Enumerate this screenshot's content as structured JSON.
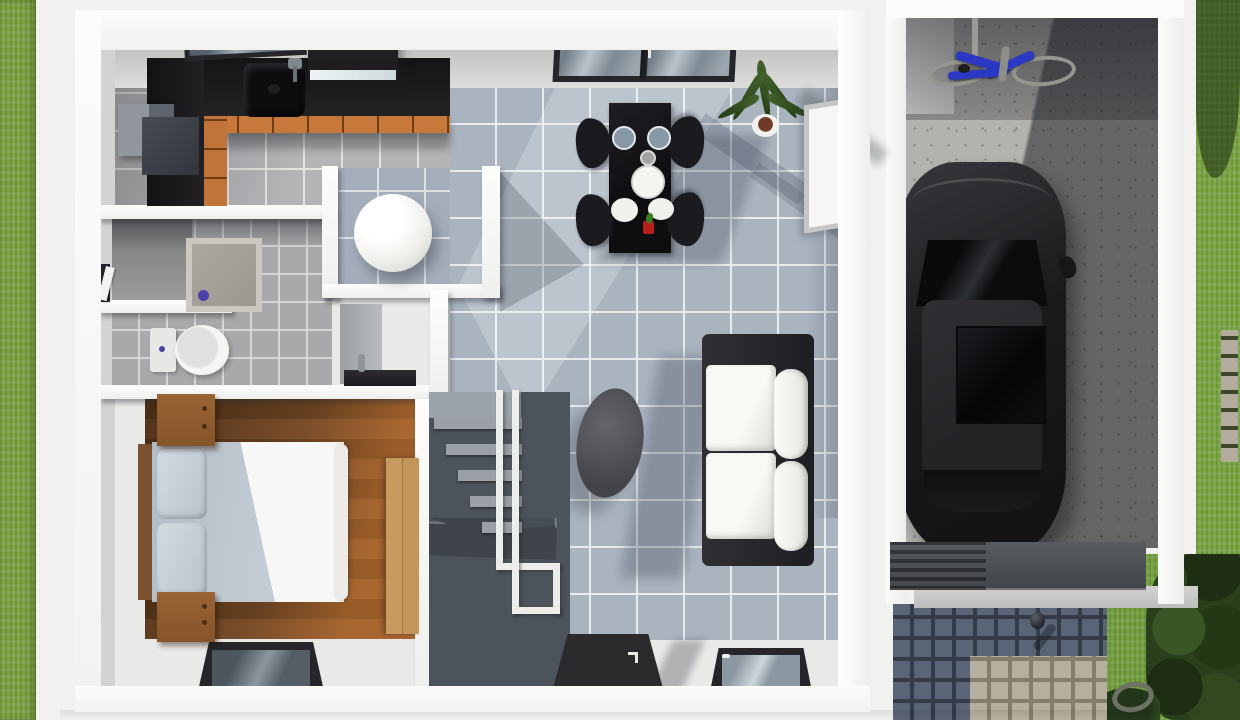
{
  "meta": {
    "kind": "3d-floor-plan-render",
    "view": "top-down isometric render",
    "width_px": 1240,
    "height_px": 720,
    "visible_text": "none"
  },
  "palette": {
    "background": "#f1f1ef",
    "grass": "#7da244",
    "wall_white": "#fbfbf9",
    "tile_dining": "#aab4bf",
    "tile_kitchen": "#b4b4b6",
    "tile_bath": "#a9a9ab",
    "wood_floor": "#6f4626",
    "counter_black": "#141416",
    "cabinet_wood": "#c7793c",
    "concrete": "#b4b2ae",
    "car_black": "#1a1a1d",
    "bike_blue": "#2a38c4",
    "cobblestone_shadow": "#596476",
    "cobblestone_light": "#b6ae9e",
    "accent_purple_drain": "#4b42a8",
    "accent_red_vase": "#b81d1d"
  },
  "house": {
    "label": "Single-storey house floor plan",
    "rooms": [
      {
        "id": "kitchen",
        "label": "Kitchen",
        "furniture": [
          "black L-shaped counter",
          "sink with faucet",
          "cooktop",
          "range hood with light",
          "refrigerator",
          "wood cabinet fronts",
          "tilted wall window"
        ]
      },
      {
        "id": "dining",
        "label": "Dining area",
        "furniture": [
          "black dining table",
          "4 black chairs",
          "2 blue-grey plates",
          "1 large white plate",
          "2 white plates",
          "grey cup",
          "red vase",
          "sliding glass door",
          "potted plant",
          "leaning picture frame"
        ]
      },
      {
        "id": "living",
        "label": "Living area",
        "furniture": [
          "black-frame sofa with white cushions",
          "oval grey coffee table",
          "front door with handle",
          "window"
        ]
      },
      {
        "id": "bathroom",
        "label": "Bathroom",
        "furniture": [
          "concrete shower tray with purple drain",
          "toilet with tank",
          "washbasin niche with faucet",
          "entry door in corridor"
        ]
      },
      {
        "id": "nook",
        "label": "Round-table nook",
        "furniture": [
          "round white table"
        ]
      },
      {
        "id": "bedroom",
        "label": "Bedroom",
        "furniture": [
          "double bed with grey sheets and white duvet",
          "2 pillows",
          "wood headboard",
          "nightstand top",
          "nightstand bottom",
          "wardrobe",
          "window"
        ]
      },
      {
        "id": "stairs",
        "label": "Staircase",
        "furniture": [
          "winder stairs dark grey",
          "upper flight light steps",
          "white handrails"
        ]
      }
    ]
  },
  "garage": {
    "label": "Garage",
    "contents": [
      "black car top view with sunroof",
      "blue bicycle on stand",
      "speckled concrete floor",
      "white side door",
      "ridged garage door slab"
    ]
  },
  "outdoor": {
    "label": "Outdoors",
    "elements": [
      "lawn strip left",
      "lawn right with tree shadow",
      "stone paver path",
      "cobblestone driveway shaded",
      "cobblestone driveway sunlit patch",
      "bollard light",
      "garden hose ring",
      "shrubs bottom right",
      "threshold strip"
    ]
  }
}
